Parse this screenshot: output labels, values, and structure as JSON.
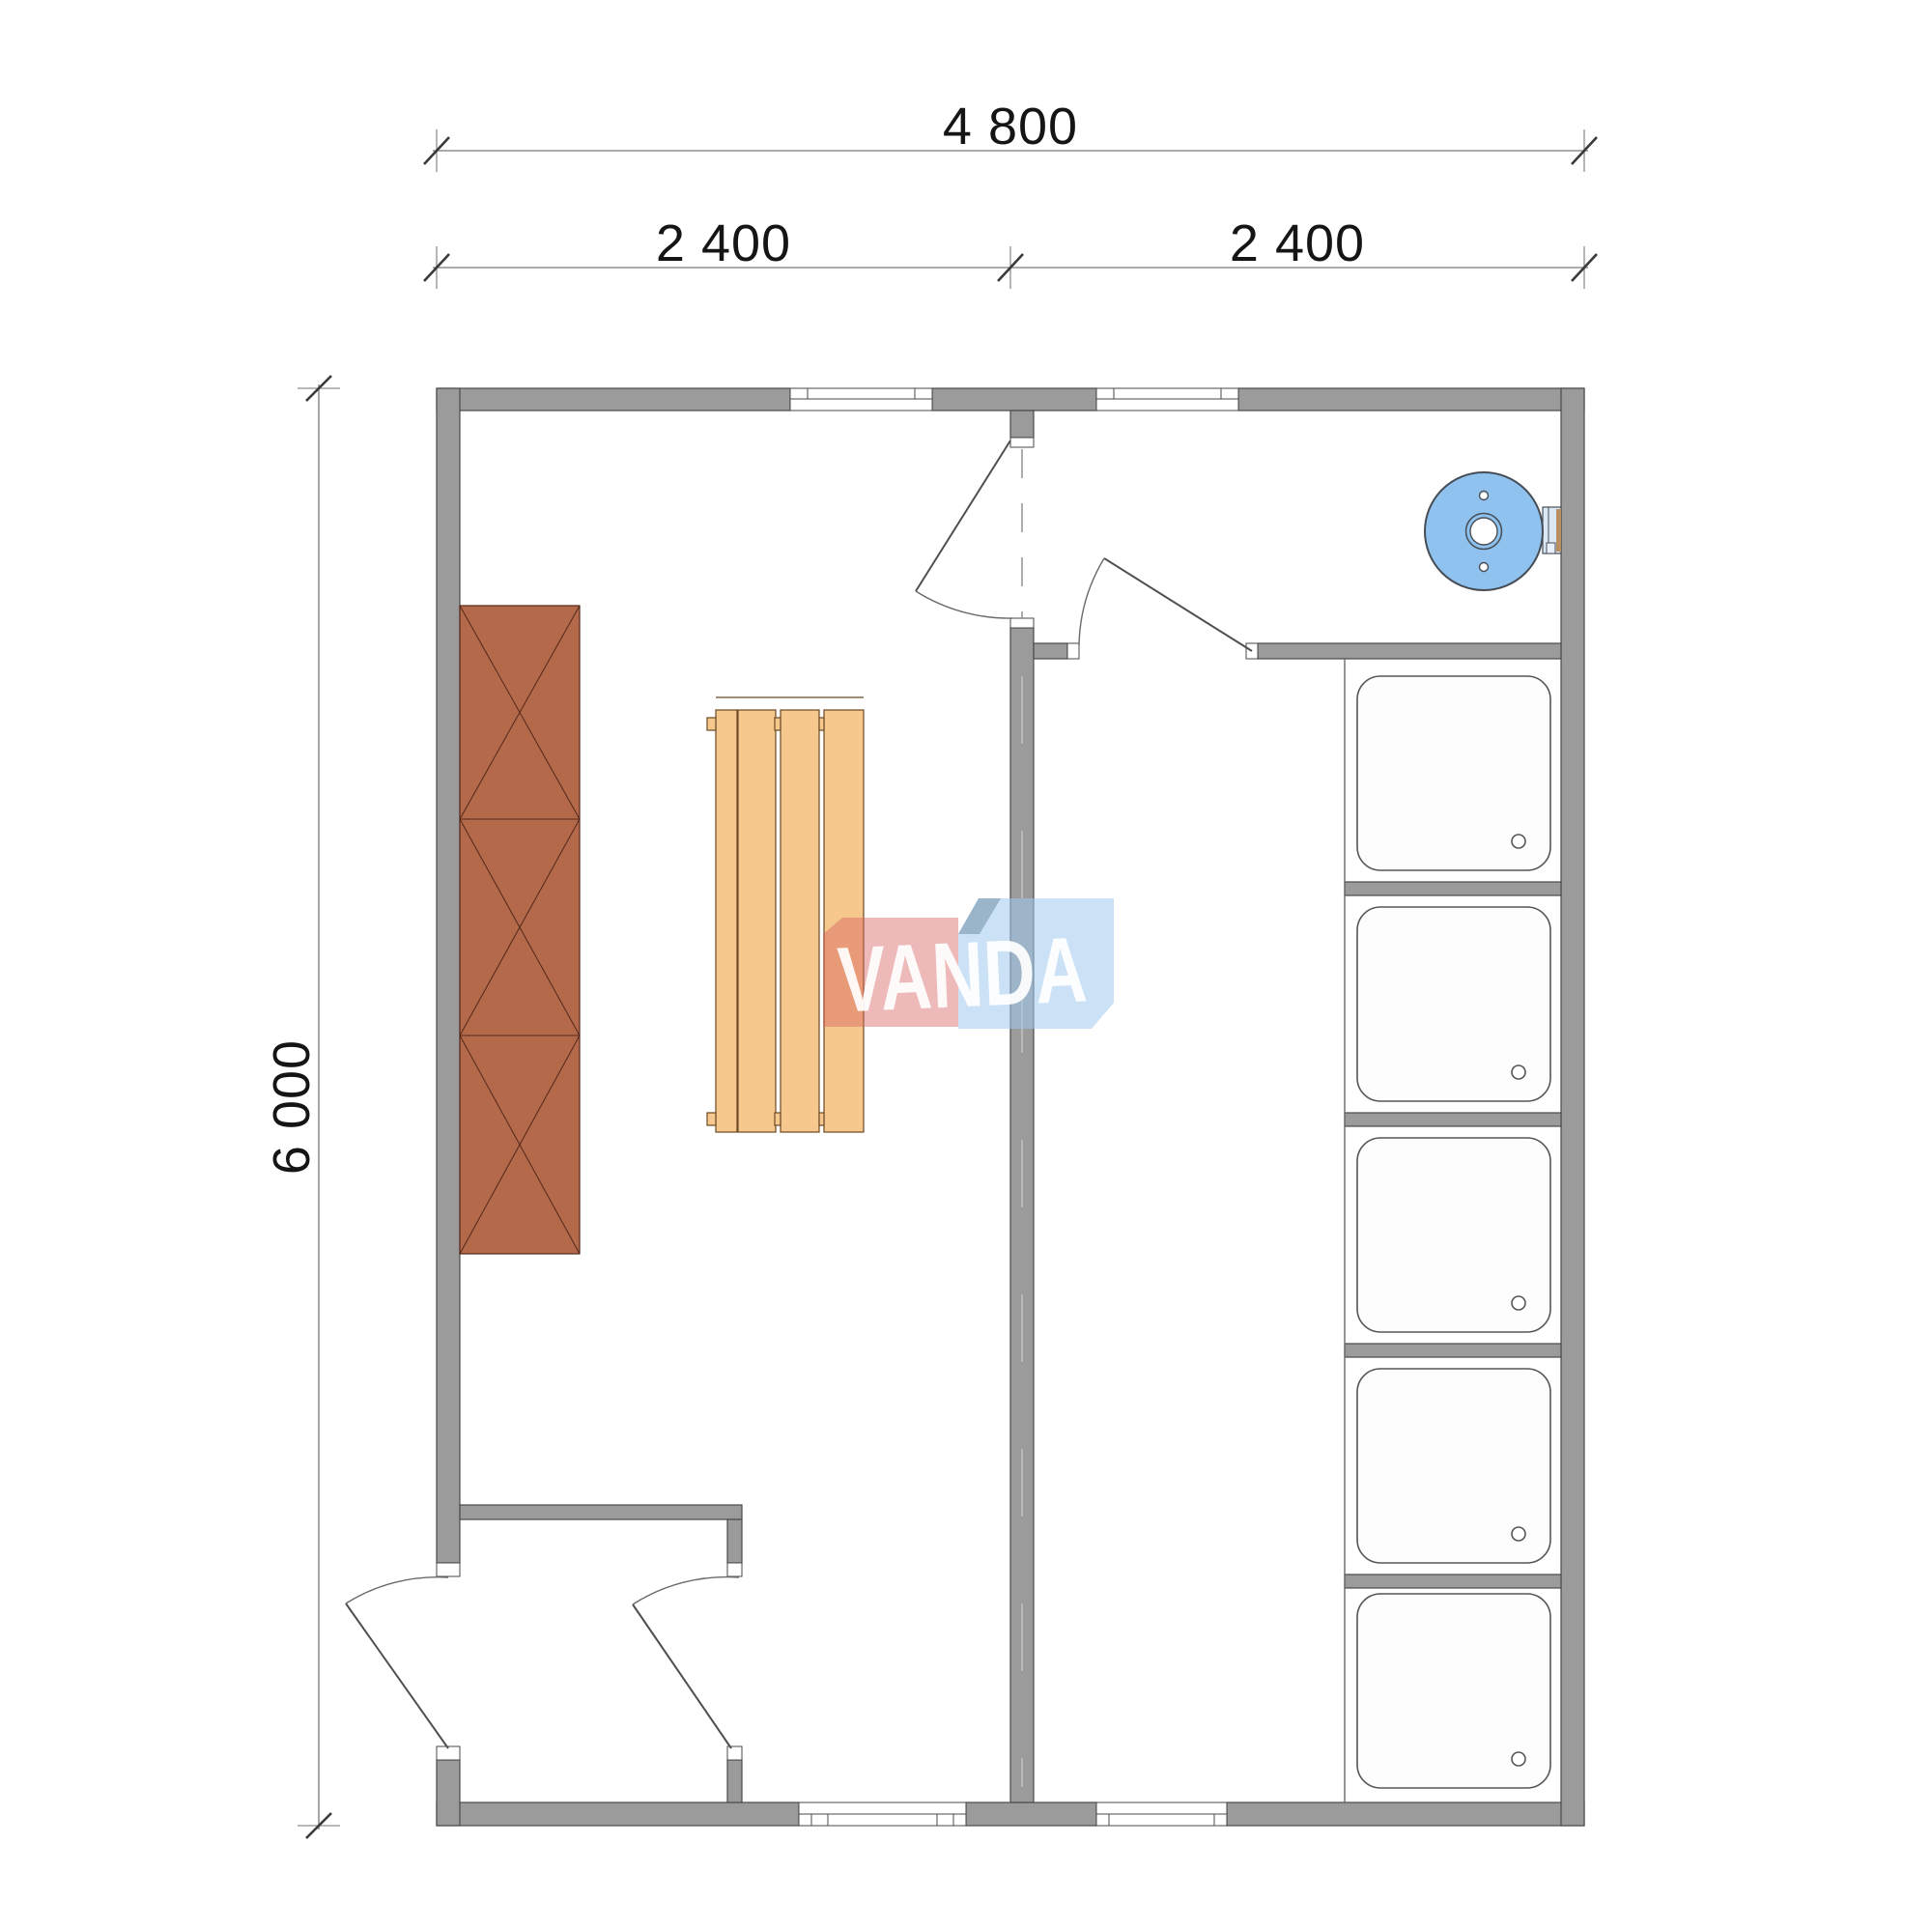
{
  "plan": {
    "dimensions": {
      "top_total": "4 800",
      "top_left_span": "2 400",
      "top_right_span": "2 400",
      "side_total": "6 000"
    },
    "watermark": "VANDA",
    "shower_tray_count": 5,
    "colors": {
      "wall_gray": "#9b9b9b",
      "cabinet_brown": "#b3694a",
      "bench_wood": "#f6c88e",
      "heater_blue": "#8fc2ef",
      "logo_red": "#d95f5f",
      "logo_blue": "#a0c8ee"
    }
  }
}
